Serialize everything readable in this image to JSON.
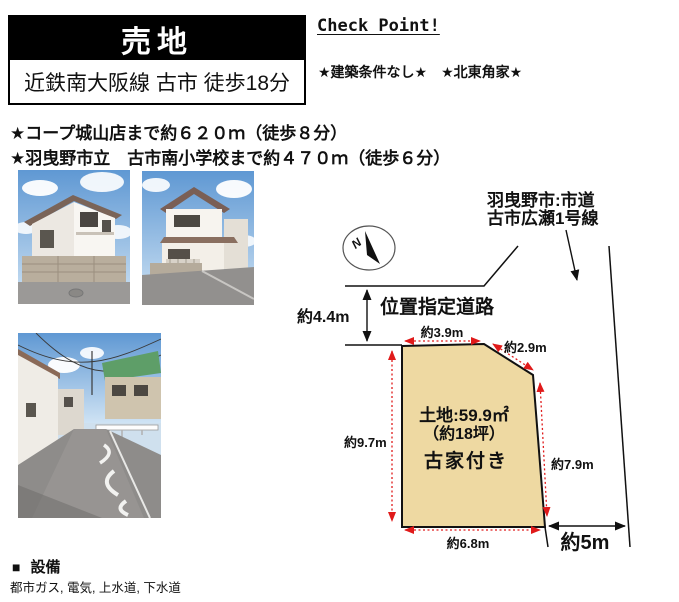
{
  "header": {
    "sale_type": "売地",
    "access": "近鉄南大阪線 古市 徒歩18分"
  },
  "check_point": {
    "title": "Check Point!",
    "stars": "★建築条件なし★　★北東角家★"
  },
  "highlights": [
    "★コープ城山店まで約６２０ｍ（徒歩８分）",
    "★羽曳野市立　古市南小学校まで約４７０ｍ（徒歩６分）"
  ],
  "photos": [
    {
      "name": "house-exterior-corner-photo"
    },
    {
      "name": "house-exterior-front-photo"
    },
    {
      "name": "front-street-photo"
    }
  ],
  "diagram": {
    "compass_label": "N",
    "city_road_name_line1": "羽曳野市:市道",
    "city_road_name_line2": "古市広瀬1号線",
    "designated_road_label": "位置指定道路",
    "front_road_width": "約4.4m",
    "side_road_width": "約5m",
    "dimensions": {
      "top": "約3.9m",
      "corner": "約2.9m",
      "left": "約9.7m",
      "right": "約7.9m",
      "bottom": "約6.8m"
    },
    "plot": {
      "area": "土地:59.9㎡",
      "tsubo": "（約18坪）",
      "note": "古家付き",
      "fill_color": "#eed9a2"
    },
    "dimension_color": "#e01a1a"
  },
  "facilities": {
    "heading_marker": "■",
    "heading": "設備",
    "items": "都市ガス, 電気, 上水道, 下水道"
  }
}
